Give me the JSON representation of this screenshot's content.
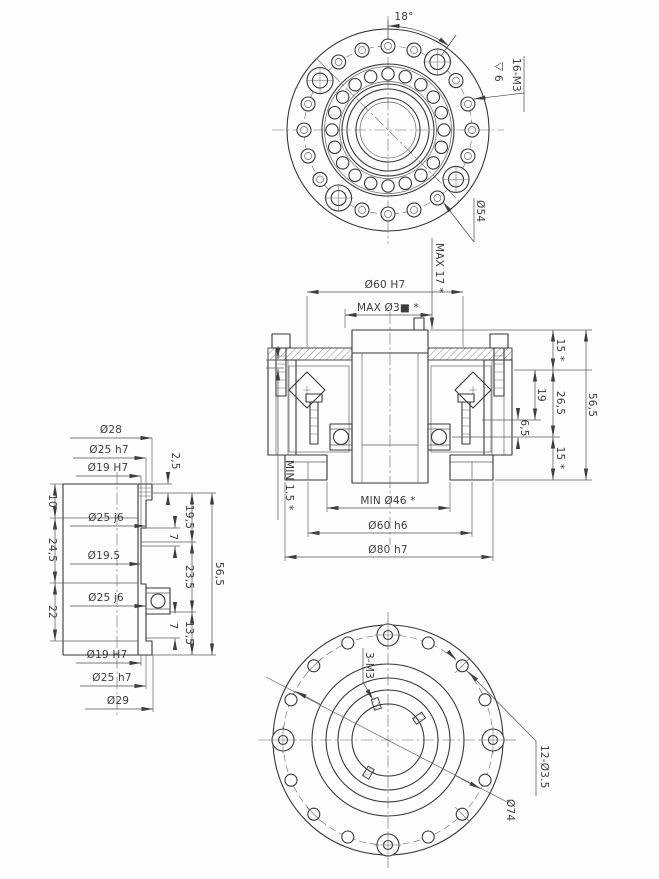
{
  "top_view": {
    "angle_dim": "18°",
    "thread_note": "16-M3",
    "thread_depth": "6",
    "bolt_circle_dia": "Ø54"
  },
  "section_view": {
    "max_screw_depth": "MAX 17 *",
    "spigot_dia": "Ø60 H7",
    "max_center_bore": "MAX Ø3■ *",
    "top_height": "15 *",
    "bearing_width": "19",
    "mid_height": "26,5",
    "step_height": "6,5",
    "total_height": "56,5",
    "bottom_height": "15 *",
    "min_clearance": "MIN 1.5 *",
    "min_hollow_dia": "MIN Ø46 *",
    "pilot_dia": "Ø60 h6",
    "outer_dia": "Ø80 h7"
  },
  "side_view": {
    "dia_flange_top": "Ø28",
    "dia_fit_top": "Ø25 h7",
    "dia_bore_top": "Ø19 H7",
    "step_top": "2,5",
    "seg_left_1": "10",
    "seg_left_2": "24,5",
    "seg_left_3": "22",
    "dia_mid_1": "Ø25 j6",
    "dia_mid_2": "Ø19.5",
    "dia_mid_3": "Ø25 j6",
    "seg_right_1": "19,5",
    "sub_right_1": "7",
    "seg_right_2": "23,5",
    "sub_right_2": "7",
    "seg_right_3": "13,5",
    "total_height": "56,5",
    "dia_bore_bottom": "Ø19 H7",
    "dia_fit_bottom": "Ø25 h7",
    "dia_flange_bottom": "Ø29"
  },
  "bottom_view": {
    "thread_note": "3-M3",
    "hole_note": "12-Ø3.5",
    "bolt_circle_dia": "Ø74"
  }
}
